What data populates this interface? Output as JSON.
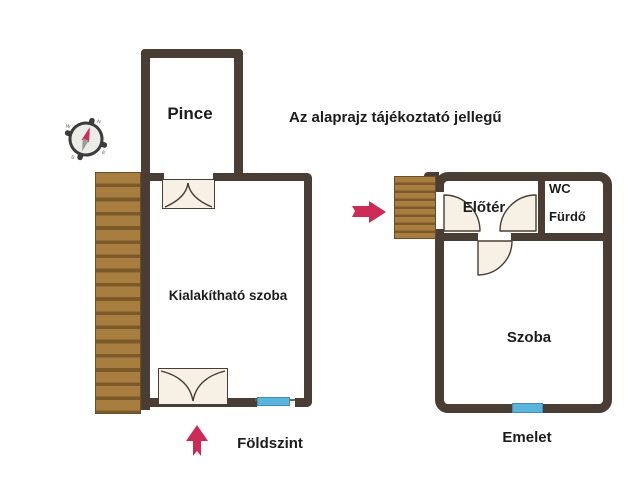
{
  "note": "Az alaprajz tájékoztató jellegű",
  "ground_floor": {
    "caption": "Földszint",
    "rooms": {
      "basement": "Pince",
      "convertible_room": "Kialakítható szoba"
    }
  },
  "upper_floor": {
    "caption": "Emelet",
    "rooms": {
      "hall": "Előtér",
      "wc": "WC",
      "bathroom": "Fürdő",
      "room": "Szoba"
    }
  },
  "compass": {
    "points": {
      "north": "N",
      "east": "E",
      "south": "S",
      "west": "W"
    }
  },
  "colors": {
    "wall": "#4a3e34",
    "stairs_wood": "#a87e40",
    "stairs_line": "#7b5a28",
    "door_fill": "#f6f1e4",
    "window_blue": "#5ab5de",
    "arrow_red": "#ce2a58",
    "text": "#1c1c1c",
    "background": "#ffffff"
  }
}
